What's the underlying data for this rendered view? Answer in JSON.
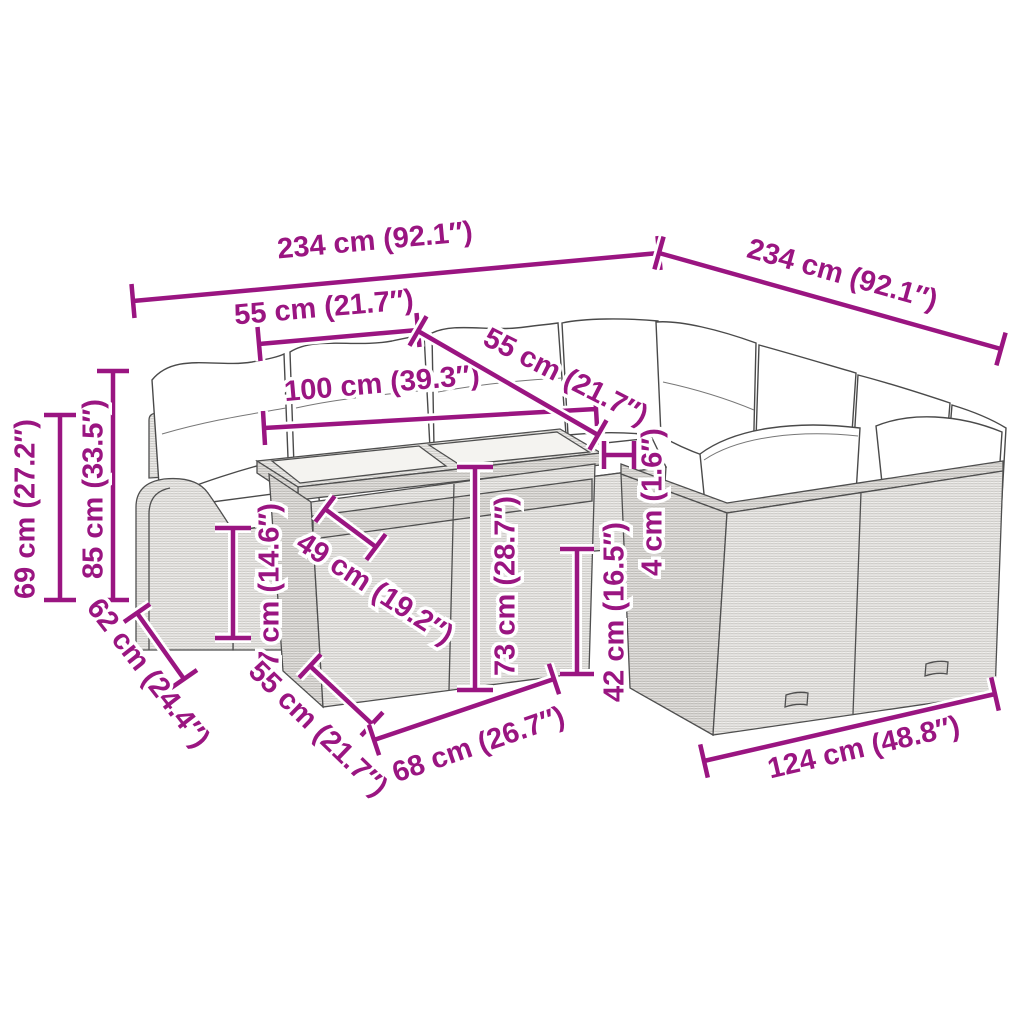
{
  "diagram": {
    "type": "product-dimension-diagram",
    "scene": "L-shaped poly rattan garden sofa set with cushions and glass-top table",
    "background": "#ffffff",
    "accent_color": "#9a1581",
    "line_art_color": "#4f4f4f"
  },
  "dims": {
    "d234_left": "234 cm (92.1″)",
    "d234_right": "234 cm (92.1″)",
    "d55_top": "55 cm (21.7″)",
    "d100": "100 cm (39.3″)",
    "d55_mid": "55 cm (21.7″)",
    "d69": "69 cm (27.2″)",
    "d85": "85 cm (33.5″)",
    "d62": "62 cm (24.4″)",
    "d37": "37 cm (14.6″)",
    "d49": "49 cm (19.2″)",
    "d73": "73 cm (28.7″)",
    "d42": "42 cm (16.5″)",
    "d4": "4 cm (1.6″)",
    "d55_bottom": "55 cm (21.7″)",
    "d68": "68 cm (26.7″)",
    "d124": "124 cm (48.8″)"
  }
}
